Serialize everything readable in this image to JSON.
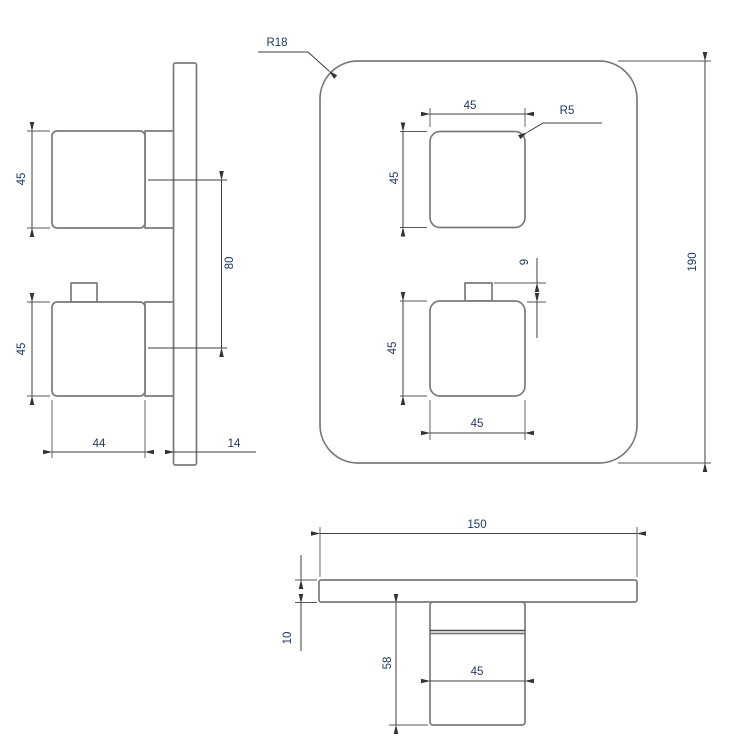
{
  "colors": {
    "background": "#ffffff",
    "part_outline": "#7a7a7a",
    "dimension_line": "#3f3f3f",
    "dimension_text": "#1f3864"
  },
  "dimensions": {
    "side_view": {
      "handle_top_height": "45",
      "handle_bottom_height": "45",
      "handle_spacing": "80",
      "handle_depth": "44",
      "base_depth": "14"
    },
    "front_view": {
      "plate_corner_radius": "R18",
      "handle_corner_radius": "R5",
      "handle_top_width": "45",
      "handle_top_height": "45",
      "tab_height": "9",
      "handle_bottom_height": "45",
      "handle_bottom_width": "45",
      "plate_height": "190"
    },
    "bottom_view": {
      "plate_width": "150",
      "plate_thickness": "10",
      "handle_projection": "58",
      "handle_width": "45"
    }
  }
}
